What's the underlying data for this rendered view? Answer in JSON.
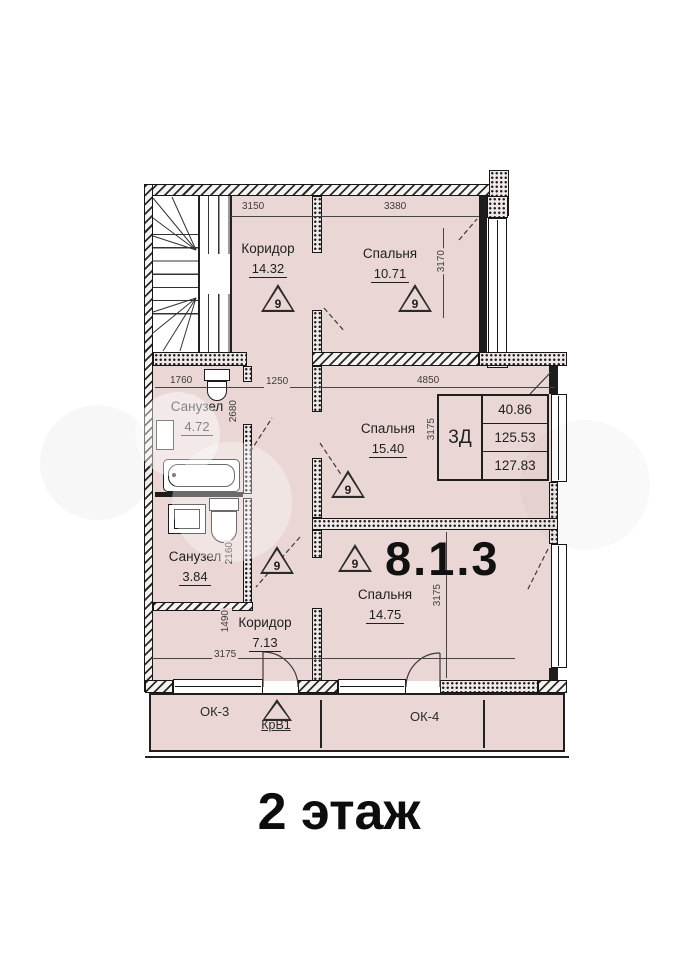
{
  "floor_title": "2 этаж",
  "apartment_number": "8.1.3",
  "rooms": [
    {
      "name": "Коридор",
      "area": "14.32"
    },
    {
      "name": "Спальня",
      "area": "10.71"
    },
    {
      "name": "Санузел",
      "area": "4.72"
    },
    {
      "name": "Спальня",
      "area": "15.40"
    },
    {
      "name": "Санузел",
      "area": "3.84"
    },
    {
      "name": "Коридор",
      "area": "7.13"
    },
    {
      "name": "Спальня",
      "area": "14.75"
    }
  ],
  "info_table": {
    "type_label": "3Д",
    "rows": [
      "40.86",
      "125.53",
      "127.83"
    ]
  },
  "dimensions": {
    "top_1": "3150",
    "top_2": "3380",
    "right_top": "3170",
    "mid_1": "1760",
    "mid_2": "1250",
    "mid_3": "4850",
    "bath_height": "2680",
    "table_side": "3175",
    "bath2_height": "2160",
    "corridor_height": "1490",
    "corridor_width": "3175",
    "bedroom3_height": "3175"
  },
  "markers": {
    "fire_triangle": "9",
    "vent_mark": "КрВ1"
  },
  "balcony": {
    "window_left": "ОК-3",
    "window_right": "ОК-4"
  },
  "colors": {
    "room_fill": "#ead7d5",
    "wall": "#1c1c1c",
    "text": "#222222"
  }
}
